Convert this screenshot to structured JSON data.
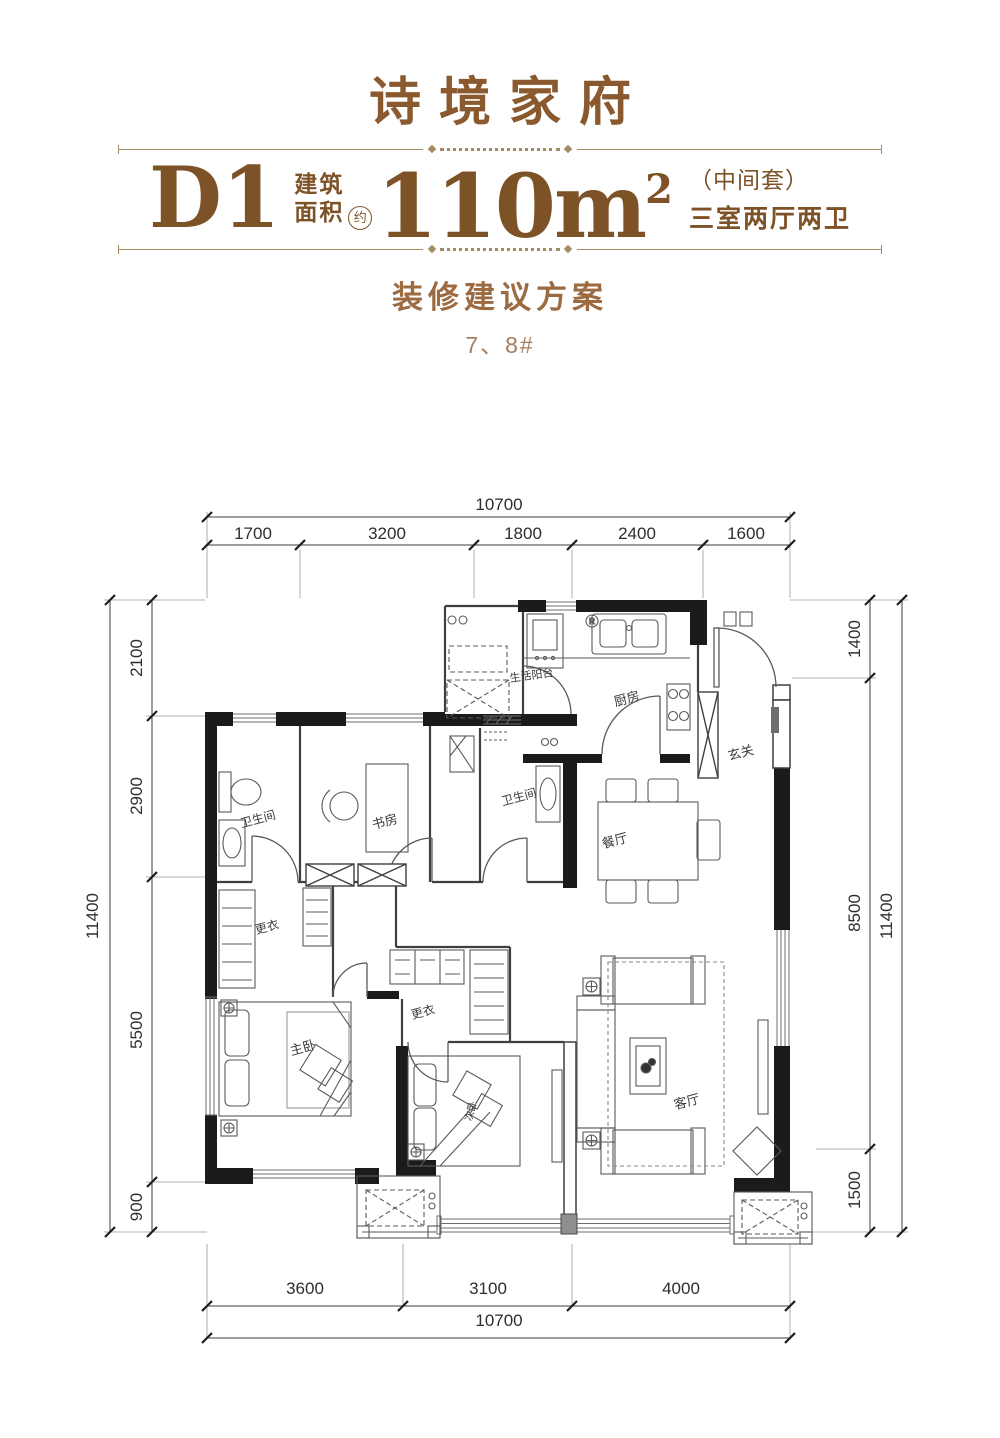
{
  "header": {
    "title": "诗境家府",
    "unit": "D1",
    "area_label_line1": "建筑",
    "area_label_line2": "面积",
    "approx": "约",
    "area_value": "110m",
    "area_sup": "2",
    "note_line1": "（中间套）",
    "note_line2": "三室两厅两卫",
    "subtitle": "装修建议方案",
    "building_no": "7、8#"
  },
  "rooms": {
    "kitchen": "厨房",
    "service_balcony": "生活阳台",
    "foyer": "玄关",
    "dining": "餐厅",
    "bath_left": "卫生间",
    "bath_right": "卫生间",
    "study": "书房",
    "dressing_left": "更衣",
    "dressing_right": "更衣",
    "master_bedroom": "主卧",
    "second_bedroom": "次卧",
    "living": "客厅"
  },
  "annotations": {
    "meter_label": "R"
  },
  "dimensions": {
    "top": {
      "overall": "10700",
      "segments": [
        "1700",
        "3200",
        "1800",
        "2400",
        "1600"
      ]
    },
    "bottom": {
      "overall": "10700",
      "segments": [
        "3600",
        "3100",
        "4000"
      ]
    },
    "left": {
      "overall": "11400",
      "segments": [
        "2100",
        "2900",
        "5500",
        "900"
      ]
    },
    "right": {
      "overall": "11400",
      "segments": [
        "1400",
        "8500",
        "1500"
      ]
    }
  },
  "colors": {
    "brand_brown": "#8a5a2e",
    "accent_brown": "#7d5226",
    "light_brown": "#9c6b42",
    "wall_black": "#1b1b1b",
    "line_gray": "#4a4a4a"
  }
}
